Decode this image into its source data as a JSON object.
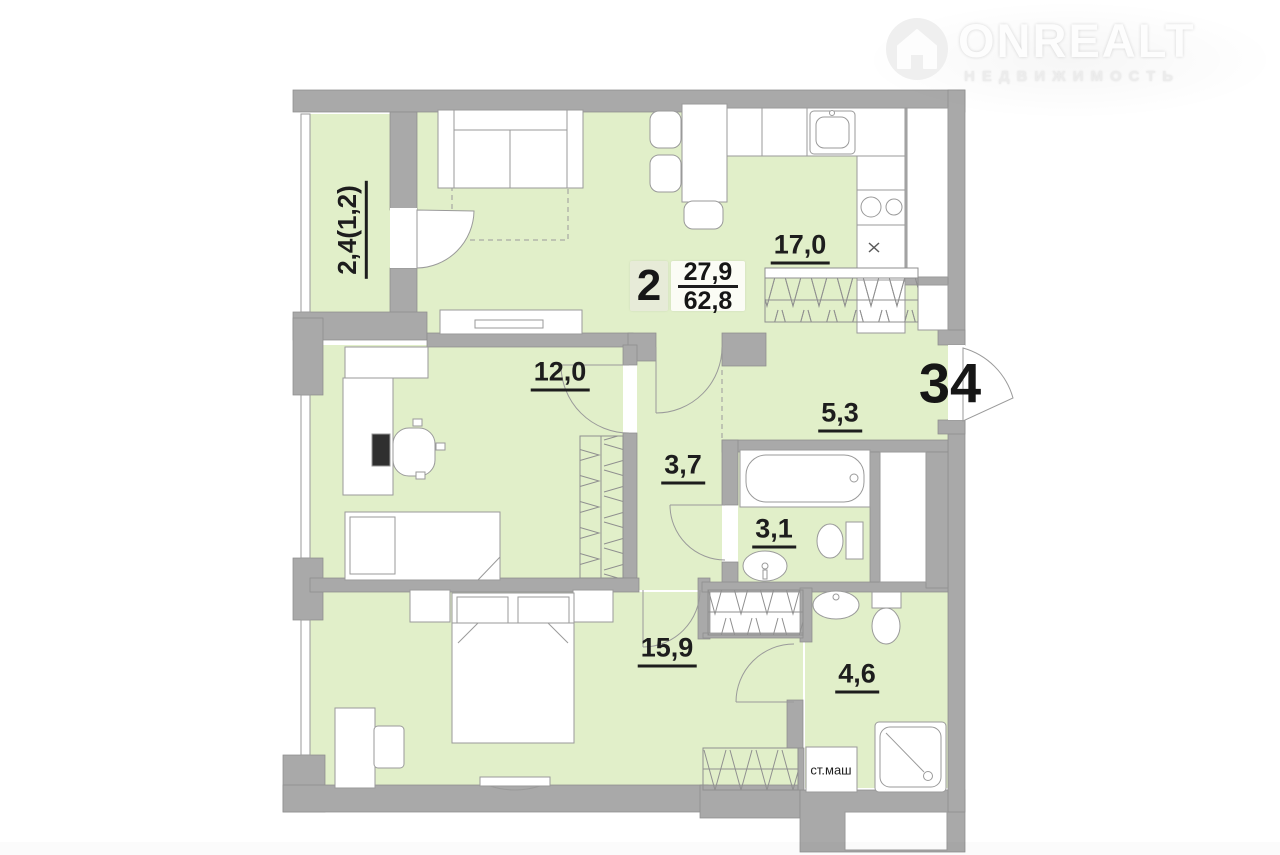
{
  "logo": {
    "title": "ONREALT",
    "subtitle": "НЕДВИЖИМОСТЬ"
  },
  "apartment": {
    "number": "34",
    "rooms_count": "2",
    "living_area": "27,9",
    "total_area": "62,8"
  },
  "rooms": [
    {
      "name": "balcony",
      "area_label": "2,4(1,2)"
    },
    {
      "name": "kitchen-living",
      "area_label": "17,0"
    },
    {
      "name": "bedroom",
      "area_label": "12,0"
    },
    {
      "name": "hallway",
      "area_label": "3,7"
    },
    {
      "name": "entry-hall",
      "area_label": "5,3"
    },
    {
      "name": "bathroom",
      "area_label": "3,1"
    },
    {
      "name": "master-bedroom",
      "area_label": "15,9"
    },
    {
      "name": "shower-room",
      "area_label": "4,6"
    }
  ],
  "labels": {
    "washing_machine": "ст.маш"
  },
  "colors": {
    "room_fill": "#e1efc9",
    "wall": "#a9a9a9",
    "furniture_outline": "#9a9a9a",
    "text": "#1d1d1d"
  }
}
